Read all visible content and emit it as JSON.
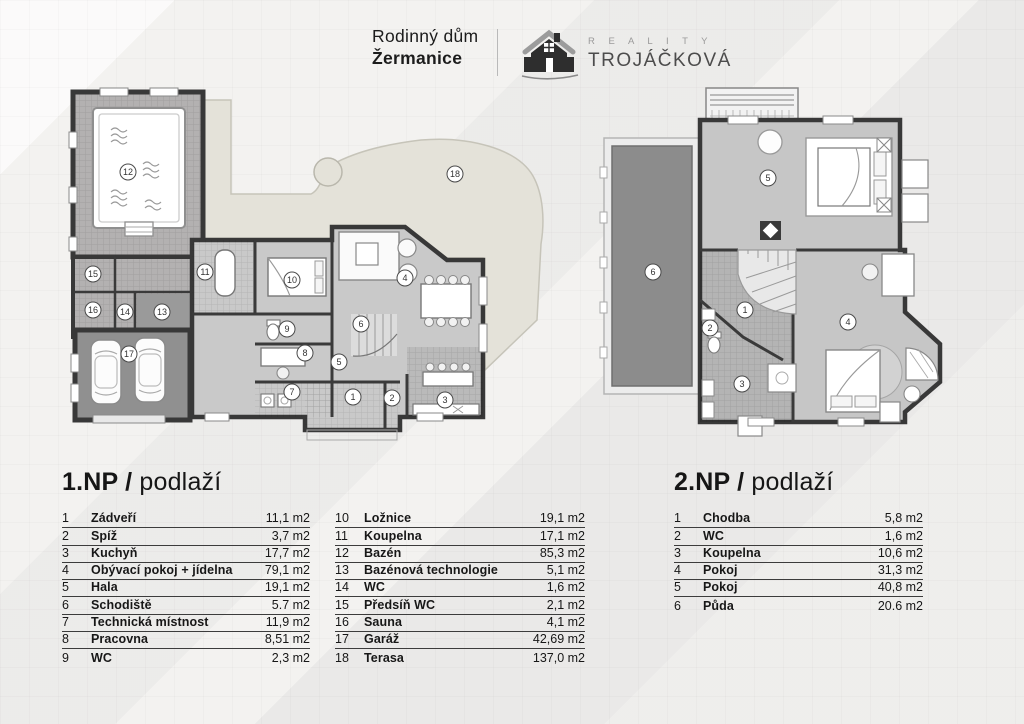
{
  "header": {
    "title_line1": "Rodinný dům",
    "title_line2": "Žermanice",
    "brand_word1": "R E A L I T Y",
    "brand_word2": "TROJÁČKOVÁ"
  },
  "floor1": {
    "heading_bold": "1.NP /",
    "heading_light": "podlaží",
    "rows_left": [
      {
        "num": "1",
        "name": "Zádveří",
        "area": "11,1 m2"
      },
      {
        "num": "2",
        "name": "Spíž",
        "area": "3,7 m2"
      },
      {
        "num": "3",
        "name": "Kuchyň",
        "area": "17,7 m2"
      },
      {
        "num": "4",
        "name": "Obývací pokoj + jídelna",
        "area": "79,1 m2"
      },
      {
        "num": "5",
        "name": "Hala",
        "area": "19,1 m2"
      },
      {
        "num": "6",
        "name": "Schodiště",
        "area": "5.7 m2"
      },
      {
        "num": "7",
        "name": "Technická místnost",
        "area": "11,9 m2"
      },
      {
        "num": "8",
        "name": "Pracovna",
        "area": "8,51 m2"
      },
      {
        "num": "9",
        "name": "WC",
        "area": "2,3 m2"
      }
    ],
    "rows_right": [
      {
        "num": "10",
        "name": "Ložnice",
        "area": "19,1 m2"
      },
      {
        "num": "11",
        "name": "Koupelna",
        "area": "17,1 m2"
      },
      {
        "num": "12",
        "name": "Bazén",
        "area": "85,3 m2"
      },
      {
        "num": "13",
        "name": "Bazénová technologie",
        "area": "5,1 m2"
      },
      {
        "num": "14",
        "name": "WC",
        "area": "1,6 m2"
      },
      {
        "num": "15",
        "name": "Předsíň WC",
        "area": "2,1 m2"
      },
      {
        "num": "16",
        "name": "Sauna",
        "area": "4,1 m2"
      },
      {
        "num": "17",
        "name": "Garáž",
        "area": "42,69 m2"
      },
      {
        "num": "18",
        "name": "Terasa",
        "area": "137,0 m2"
      }
    ],
    "markers": [
      "1",
      "2",
      "3",
      "4",
      "5",
      "6",
      "7",
      "8",
      "9",
      "10",
      "11",
      "12",
      "13",
      "14",
      "15",
      "16",
      "17",
      "18"
    ]
  },
  "floor2": {
    "heading_bold": "2.NP /",
    "heading_light": "podlaží",
    "rows": [
      {
        "num": "1",
        "name": "Chodba",
        "area": "5,8 m2"
      },
      {
        "num": "2",
        "name": "WC",
        "area": "1,6 m2"
      },
      {
        "num": "3",
        "name": "Koupelna",
        "area": "10,6 m2"
      },
      {
        "num": "4",
        "name": "Pokoj",
        "area": "31,3 m2"
      },
      {
        "num": "5",
        "name": "Pokoj",
        "area": "40,8 m2"
      },
      {
        "num": "6",
        "name": "Půda",
        "area": "20.6 m2"
      }
    ],
    "markers": [
      "1",
      "2",
      "3",
      "4",
      "5",
      "6"
    ]
  },
  "colors": {
    "wall": "#383838",
    "floor_gray": "#c9c9c9",
    "terrace_beige": "#e4e2d9",
    "dark_floor": "#8f8f8f"
  }
}
